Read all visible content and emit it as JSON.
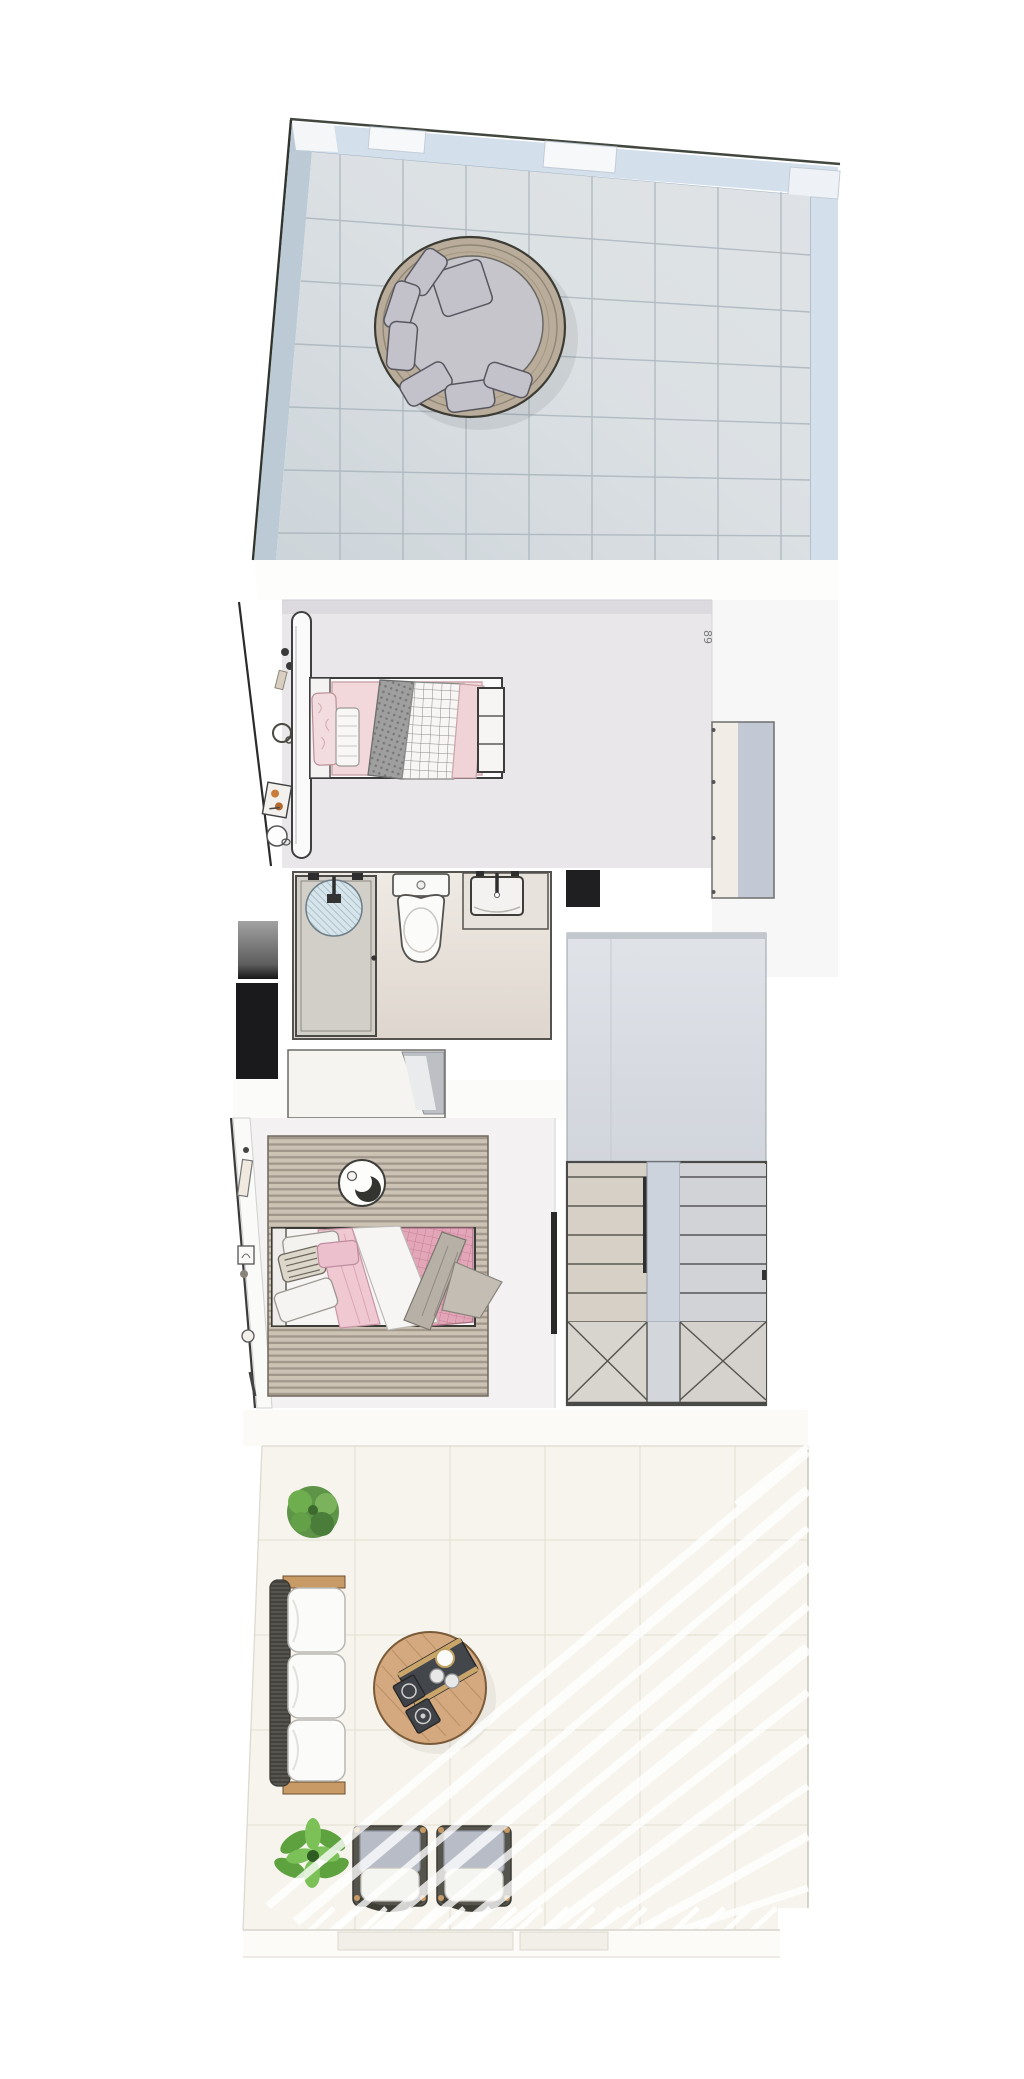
{
  "plan": {
    "kind": "3d-rendered floor plan, top-down view",
    "unit_label": "89",
    "rooms": [
      {
        "name": "roof-terrace",
        "floor": "light blue-gray tiles",
        "furniture": [
          "round-daybed with gray cushions"
        ]
      },
      {
        "name": "bedroom-1",
        "floor": "light gray",
        "furniture": [
          "double-bed pink bedding",
          "foot-bench",
          "tall-oval-panel",
          "wall-shelf-objects"
        ]
      },
      {
        "name": "bathroom",
        "floor": "beige",
        "furniture": [
          "walk-in-shower",
          "toilet",
          "sink-vanity"
        ]
      },
      {
        "name": "hallway-landing",
        "floor": "blue-gray",
        "furniture": [
          "u-shaped-staircase"
        ]
      },
      {
        "name": "bedroom-2",
        "floor": "off-white",
        "furniture": [
          "double-bed pink bedding",
          "striped-area-rug",
          "wardrobe",
          "round-crescent-ornament"
        ]
      },
      {
        "name": "living-terrace",
        "floor": "cream tiles with sunlight streaks",
        "furniture": [
          "wicker-sofa",
          "round-wood-coffee-table",
          "armchair",
          "armchair",
          "potted-plant",
          "potted-plant"
        ]
      }
    ],
    "colors": {
      "background": "#ffffff",
      "terrace_tile": "#dfe3e6",
      "terrace_grid": "#b3bcc2",
      "railing": "#d3dfeb",
      "daybed_wicker": "#b9ac9a",
      "daybed_cushion": "#c7c5cc",
      "bedroom1_floor": "#e9e7ea",
      "bed_pink": "#f2d8da",
      "bathroom_floor": "#eae6e2",
      "shower_floor": "#d2cec8",
      "landing": "#dadde3",
      "stair_left_flight": "#d7d0c7",
      "stair_right_flight": "#d2d3d7",
      "stair_landing_strip": "#ccd3dd",
      "rug": "#c9c0b2",
      "bed2_pink": "#e3a8ba",
      "living_floor": "#f6f4ec",
      "wood": "#c79a66",
      "wicker_dark": "#55544c",
      "chair_back": "#b7bcc6",
      "plant_green": "#5da23e",
      "accent_black": "#1a191b"
    }
  }
}
